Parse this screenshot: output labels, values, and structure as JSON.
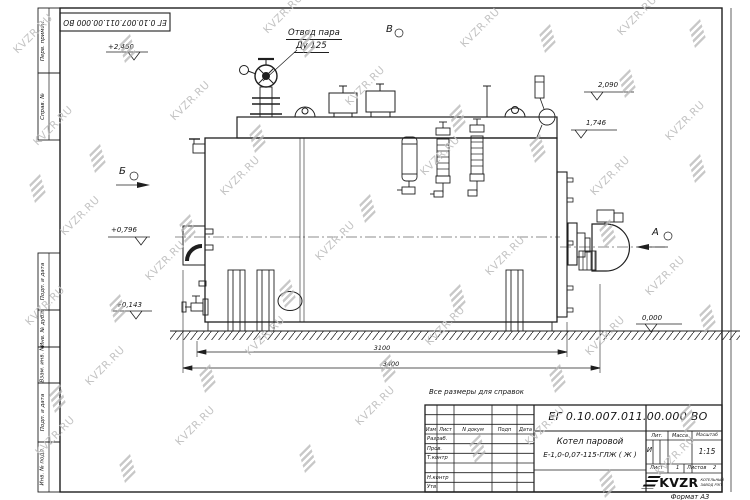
{
  "watermark": {
    "text": "KVZR.RU"
  },
  "sheet": {
    "top_stamp": "ЕГ 0.10.007.011.00.000 ВО",
    "format_label": "Формат А3",
    "margin_labels": [
      "Перв. примен.",
      "Справ. №",
      "Подп. и дата",
      "Инв. № дубл.",
      "Взам. инв. №",
      "Подп. и дата",
      "Инв. № подл."
    ]
  },
  "drawing": {
    "note": "Все размеры для справок",
    "callout_line1": "Отвод пара",
    "callout_line2": "Ду 125",
    "view_b": "Б",
    "view_v": "В",
    "view_a": "А",
    "elev_2450": "+2,450",
    "elev_2090": "2,090",
    "elev_1746": "1,746",
    "elev_0796": "+0,796",
    "elev_0143": "+0,143",
    "elev_0000": "0,000",
    "dim_inner": "3100",
    "dim_overall": "3400"
  },
  "title_block": {
    "doc_number": "ЕГ 0.10.007.011.00.000 ВО",
    "name_line1": "Котел паровой",
    "name_line2": "Е-1,0-0,07-115-ГЛЖ ( Ж )",
    "col_izm": "Изм",
    "col_list": "Лист",
    "col_ndokum": "N докум",
    "col_podp": "Подп",
    "col_data": "Дата",
    "row_razrab": "Разраб.",
    "row_prov": "Пров.",
    "row_tkontr": "Т.контр",
    "row_nkontr": "Н.контр",
    "row_utv": "Утв.",
    "lit_label": "Лит.",
    "massa_label": "Масса",
    "masshtab_label": "Масштаб",
    "lit_value": "И",
    "scale_value": "1:15",
    "list_label": "Лист",
    "list_value": "1",
    "listov_label": "Листов",
    "listov_value": "2",
    "logo_text": "KVZR",
    "logo_sub1": "КОТЕЛЬНЫЙ",
    "logo_sub2": "ЗАВОД РЭП"
  }
}
